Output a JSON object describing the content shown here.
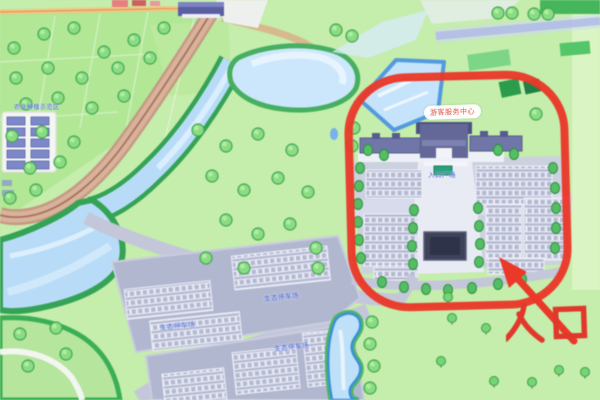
{
  "map": {
    "annotation": {
      "entrance": "入口",
      "color": "#e5392b",
      "shape": "red-rounded-circle-with-arrow"
    },
    "labels": {
      "visitor_center": "游客服务中心",
      "plaza": "入口广场",
      "parking_a": "生态停车场",
      "parking_b": "生态停车场",
      "parking_c": "生态停车场",
      "compound": "农业种植示范区"
    },
    "colors": {
      "annotation_red": "#e5392b",
      "grass": "#c6ecae",
      "field_green": "#b2e697",
      "water": "#b9dcf6",
      "bank_green": "#38a258",
      "parking_gray": "#b2b7cf",
      "plaza_gray": "#ccd0e0",
      "roof_blue": "#636896",
      "track_tan": "#c49a83",
      "label_blue": "#2b4fd0"
    }
  }
}
